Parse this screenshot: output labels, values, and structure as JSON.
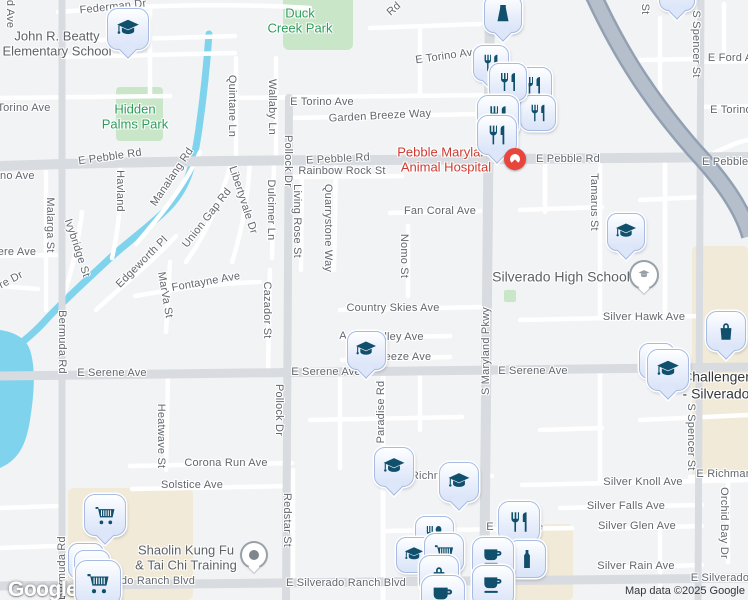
{
  "map": {
    "attribution": {
      "logo": "Google",
      "map_data": "Map data ©2025 Google"
    },
    "colors": {
      "background": "#f2f3f5",
      "minor_road": "#ffffff",
      "major_road": "#d8dbdf",
      "highway": "#b5bfcc",
      "highway_casing": "#93a0b2",
      "water": "#7fd3ec",
      "park_fill": "#c9e7c8",
      "park_label": "#2d9d5c",
      "commercial_fill": "#f1ead9",
      "marker_fill": "#e8eefb",
      "marker_border": "#a7bbe3",
      "marker_icon": "#11506d",
      "red_poi": "#cf3a30",
      "red_pin": "#e8453c",
      "street_label": "#62676e"
    },
    "street_labels": [
      {
        "text": "Federman Dr",
        "x": 113,
        "y": 7,
        "r": -6
      },
      {
        "text": "d Ave",
        "x": 10,
        "y": 14,
        "r": 90
      },
      {
        "text": "Torino Ave",
        "x": 24,
        "y": 108,
        "r": 0
      },
      {
        "text": "ino Ave",
        "x": 16,
        "y": 176,
        "r": 0
      },
      {
        "text": "E Torino Ave",
        "x": 322,
        "y": 102,
        "r": 0
      },
      {
        "text": "E Torino Ave",
        "x": 447,
        "y": 56,
        "r": -8
      },
      {
        "text": "Garden Breeze Way",
        "x": 380,
        "y": 116,
        "r": -3
      },
      {
        "text": "E Pebble Rd",
        "x": 110,
        "y": 157,
        "r": -8
      },
      {
        "text": "E Pebble Rd",
        "x": 338,
        "y": 159,
        "r": -3
      },
      {
        "text": "Rainbow Rock St",
        "x": 342,
        "y": 171,
        "r": 0
      },
      {
        "text": "E Pebble Rd",
        "x": 568,
        "y": 159,
        "r": 0
      },
      {
        "text": "E Pebble Rd",
        "x": 734,
        "y": 162,
        "r": 0
      },
      {
        "text": "Quintane Ln",
        "x": 232,
        "y": 106,
        "r": 90
      },
      {
        "text": "Wallaby Ln",
        "x": 272,
        "y": 107,
        "r": 90
      },
      {
        "text": "Pollock Dr",
        "x": 288,
        "y": 161,
        "r": 90
      },
      {
        "text": "Pollock Dr",
        "x": 279,
        "y": 410,
        "r": 90
      },
      {
        "text": "Manalang Rd",
        "x": 172,
        "y": 177,
        "r": -56
      },
      {
        "text": "Havland",
        "x": 120,
        "y": 191,
        "r": 90
      },
      {
        "text": "Quarrystone Way",
        "x": 328,
        "y": 228,
        "r": 90
      },
      {
        "text": "Living Rose St",
        "x": 297,
        "y": 221,
        "r": 90
      },
      {
        "text": "Libertyvale Dr",
        "x": 243,
        "y": 200,
        "r": 72
      },
      {
        "text": "Dulcimer Ln",
        "x": 271,
        "y": 210,
        "r": 90
      },
      {
        "text": "Union Gap Rd",
        "x": 207,
        "y": 218,
        "r": -52
      },
      {
        "text": "Edgeworth Pl",
        "x": 142,
        "y": 262,
        "r": -45
      },
      {
        "text": "Fontayne Ave",
        "x": 206,
        "y": 282,
        "r": -10
      },
      {
        "text": "MarVa St",
        "x": 165,
        "y": 295,
        "r": 80
      },
      {
        "text": "Cazador St",
        "x": 267,
        "y": 310,
        "r": 90
      },
      {
        "text": "Malarga St",
        "x": 50,
        "y": 225,
        "r": 90
      },
      {
        "text": "Ivybridge St",
        "x": 77,
        "y": 248,
        "r": 72
      },
      {
        "text": "ere Ave",
        "x": 17,
        "y": 252,
        "r": 0
      },
      {
        "text": "re Dr",
        "x": 11,
        "y": 280,
        "r": -28
      },
      {
        "text": "Bermuda Rd",
        "x": 62,
        "y": 342,
        "r": 90
      },
      {
        "text": "Bermuda Rd",
        "x": 62,
        "y": 568,
        "r": -90
      },
      {
        "text": "Fan Coral Ave",
        "x": 440,
        "y": 211,
        "r": 0
      },
      {
        "text": "Nomo St",
        "x": 404,
        "y": 256,
        "r": 90
      },
      {
        "text": "Tamarus St",
        "x": 594,
        "y": 202,
        "r": 90
      },
      {
        "text": "S Spencer St",
        "x": 696,
        "y": 44,
        "r": 90
      },
      {
        "text": "S Spencer St",
        "x": 691,
        "y": 437,
        "r": 90
      },
      {
        "text": "E Ford Ave",
        "x": 736,
        "y": 58,
        "r": 0
      },
      {
        "text": "E Torino Ave",
        "x": 742,
        "y": 110,
        "r": 0
      },
      {
        "text": "St",
        "x": 645,
        "y": 9,
        "r": 90
      },
      {
        "text": "Rd",
        "x": 394,
        "y": 9,
        "r": -42
      },
      {
        "text": "Country Skies Ave",
        "x": 393,
        "y": 308,
        "r": 0
      },
      {
        "text": "A",
        "x": 343,
        "y": 336,
        "r": 0
      },
      {
        "text": "lley Ave",
        "x": 404,
        "y": 337,
        "r": 0
      },
      {
        "text": "reeze Ave",
        "x": 406,
        "y": 357,
        "r": 0
      },
      {
        "text": "E Serene Ave",
        "x": 112,
        "y": 373,
        "r": 0
      },
      {
        "text": "E Serene Ave",
        "x": 326,
        "y": 372,
        "r": 0
      },
      {
        "text": "E Serene Ave",
        "x": 533,
        "y": 371,
        "r": 0
      },
      {
        "text": "Silver Hawk Ave",
        "x": 644,
        "y": 317,
        "r": 0
      },
      {
        "text": "S Maryland Pkwy",
        "x": 486,
        "y": 351,
        "r": -90
      },
      {
        "text": "Paradise Rd",
        "x": 381,
        "y": 412,
        "r": -90
      },
      {
        "text": "Heatwave St",
        "x": 161,
        "y": 436,
        "r": 90
      },
      {
        "text": "Corona Run Ave",
        "x": 226,
        "y": 463,
        "r": 0
      },
      {
        "text": "Solstice Ave",
        "x": 192,
        "y": 485,
        "r": 0
      },
      {
        "text": "Redstar St",
        "x": 287,
        "y": 520,
        "r": 90
      },
      {
        "text": "Richm",
        "x": 427,
        "y": 476,
        "r": 0
      },
      {
        "text": "Silver Knoll Ave",
        "x": 643,
        "y": 482,
        "r": 0
      },
      {
        "text": "Silver Falls Ave",
        "x": 626,
        "y": 506,
        "r": 0
      },
      {
        "text": "Silver Glen Ave",
        "x": 637,
        "y": 526,
        "r": 0
      },
      {
        "text": "Silver Rain Ave",
        "x": 636,
        "y": 566,
        "r": 0
      },
      {
        "text": "E Richmar Ave",
        "x": 734,
        "y": 474,
        "r": 0
      },
      {
        "text": "Orchid Bay Dr",
        "x": 724,
        "y": 523,
        "r": 90
      },
      {
        "text": "E",
        "x": 490,
        "y": 527,
        "r": 0
      },
      {
        "text": "e",
        "x": 540,
        "y": 527,
        "r": 0
      },
      {
        "text": "E Silverado Ranch Blvd",
        "x": 346,
        "y": 583,
        "r": 0
      },
      {
        "text": "do Ranch Blvd",
        "x": 158,
        "y": 581,
        "r": 0
      },
      {
        "text": "E Silverado Ranch",
        "x": 738,
        "y": 578,
        "r": 0
      }
    ],
    "poi_labels": [
      {
        "lines": [
          "John R. Beatty",
          "Elementary School"
        ],
        "x": 57,
        "y": 44,
        "color": "gray",
        "big": false
      },
      {
        "lines": [
          "Duck",
          "Creek Park"
        ],
        "x": 300,
        "y": 21,
        "color": "green",
        "big": false
      },
      {
        "lines": [
          "Hidden",
          "Palms Park"
        ],
        "x": 135,
        "y": 117,
        "color": "green",
        "big": false
      },
      {
        "lines": [
          "Pebble Maryland",
          "Animal Hospital"
        ],
        "x": 446,
        "y": 160,
        "color": "red",
        "big": false
      },
      {
        "lines": [
          "Silverado High School"
        ],
        "x": 561,
        "y": 277,
        "color": "gray",
        "big": true
      },
      {
        "lines": [
          "Challenger",
          "- Silverado"
        ],
        "x": 716,
        "y": 385,
        "color": "dark",
        "big": true
      },
      {
        "lines": [
          "Shaolin Kung Fu",
          "& Tai Chi Training"
        ],
        "x": 186,
        "y": 558,
        "color": "gray",
        "big": false
      }
    ],
    "markers": [
      {
        "type": "school-pin",
        "icon": "school-icon",
        "x": 127,
        "y": 28,
        "s": 40,
        "tail": true
      },
      {
        "type": "poi-pin-partial",
        "icon": "none",
        "x": 676,
        "y": -8,
        "s": 34,
        "tail": true
      },
      {
        "type": "clothing-pin",
        "icon": "clothing-icon",
        "x": 502,
        "y": 13,
        "s": 36,
        "tail": true
      },
      {
        "type": "restaurant-pin",
        "icon": "restaurant-icon",
        "x": 490,
        "y": 62,
        "s": 34,
        "tail": true
      },
      {
        "type": "restaurant-pin",
        "icon": "restaurant-icon",
        "x": 532,
        "y": 85,
        "s": 36,
        "tail": true
      },
      {
        "type": "restaurant-pin",
        "icon": "restaurant-icon",
        "x": 537,
        "y": 112,
        "s": 34,
        "tail": false
      },
      {
        "type": "restaurant-pin",
        "icon": "restaurant-icon",
        "x": 507,
        "y": 81,
        "s": 36,
        "tail": true
      },
      {
        "type": "restaurant-pin",
        "icon": "restaurant-icon",
        "x": 497,
        "y": 115,
        "s": 40,
        "tail": true
      },
      {
        "type": "restaurant-pin",
        "icon": "restaurant-icon",
        "x": 496,
        "y": 134,
        "s": 38,
        "tail": true
      },
      {
        "type": "red-pin",
        "icon": "red-dot",
        "x": 515,
        "y": 159,
        "s": 22,
        "tail": true
      },
      {
        "type": "school-pin",
        "icon": "school-icon",
        "x": 625,
        "y": 231,
        "s": 36,
        "tail": true
      },
      {
        "type": "school-circle",
        "icon": "school-circle-icon",
        "x": 644,
        "y": 275,
        "s": 26,
        "tail": true
      },
      {
        "type": "bag-pin",
        "icon": "bag-icon",
        "x": 725,
        "y": 330,
        "s": 38,
        "tail": true
      },
      {
        "type": "school-pin",
        "icon": "school-icon",
        "x": 365,
        "y": 349,
        "s": 37,
        "tail": true
      },
      {
        "type": "school-pin",
        "icon": "school-icon",
        "x": 656,
        "y": 360,
        "s": 34,
        "tail": false
      },
      {
        "type": "school-pin",
        "icon": "school-icon",
        "x": 667,
        "y": 369,
        "s": 40,
        "tail": true
      },
      {
        "type": "school-pin",
        "icon": "school-icon",
        "x": 393,
        "y": 466,
        "s": 38,
        "tail": true
      },
      {
        "type": "school-pin",
        "icon": "school-icon",
        "x": 458,
        "y": 481,
        "s": 38,
        "tail": true
      },
      {
        "type": "restaurant-pin",
        "icon": "restaurant-icon",
        "x": 518,
        "y": 521,
        "s": 40,
        "tail": true
      },
      {
        "type": "restaurant-pin",
        "icon": "restaurant-alt-icon",
        "x": 433,
        "y": 534,
        "s": 37,
        "tail": true
      },
      {
        "type": "school-pin",
        "icon": "school-icon",
        "x": 413,
        "y": 554,
        "s": 34,
        "tail": false
      },
      {
        "type": "cart-pin",
        "icon": "cart-icon",
        "x": 443,
        "y": 552,
        "s": 38,
        "tail": false
      },
      {
        "type": "bottle-pin",
        "icon": "bottle-icon",
        "x": 526,
        "y": 558,
        "s": 36,
        "tail": false
      },
      {
        "type": "bag-pin",
        "icon": "bag-icon",
        "x": 438,
        "y": 574,
        "s": 38,
        "tail": false
      },
      {
        "type": "cafe-pin",
        "icon": "cafe-icon",
        "x": 492,
        "y": 557,
        "s": 40,
        "tail": true
      },
      {
        "type": "cafe-pin",
        "icon": "cafe-icon",
        "x": 492,
        "y": 585,
        "s": 40,
        "tail": false
      },
      {
        "type": "cafe-pin",
        "icon": "cafe-icon",
        "x": 442,
        "y": 596,
        "s": 42,
        "tail": false
      },
      {
        "type": "cart-pin",
        "icon": "cart-icon",
        "x": 104,
        "y": 514,
        "s": 40,
        "tail": true
      },
      {
        "type": "poi-pin-partial",
        "icon": "none",
        "x": 85,
        "y": 560,
        "s": 34,
        "tail": false
      },
      {
        "type": "poi-pin-partial",
        "icon": "none",
        "x": 91,
        "y": 567,
        "s": 34,
        "tail": false
      },
      {
        "type": "cart-pin",
        "icon": "cart-icon",
        "x": 97,
        "y": 582,
        "s": 44,
        "tail": false
      },
      {
        "type": "dot-circle",
        "icon": "dot-icon",
        "x": 254,
        "y": 555,
        "s": 24,
        "tail": true
      }
    ]
  }
}
